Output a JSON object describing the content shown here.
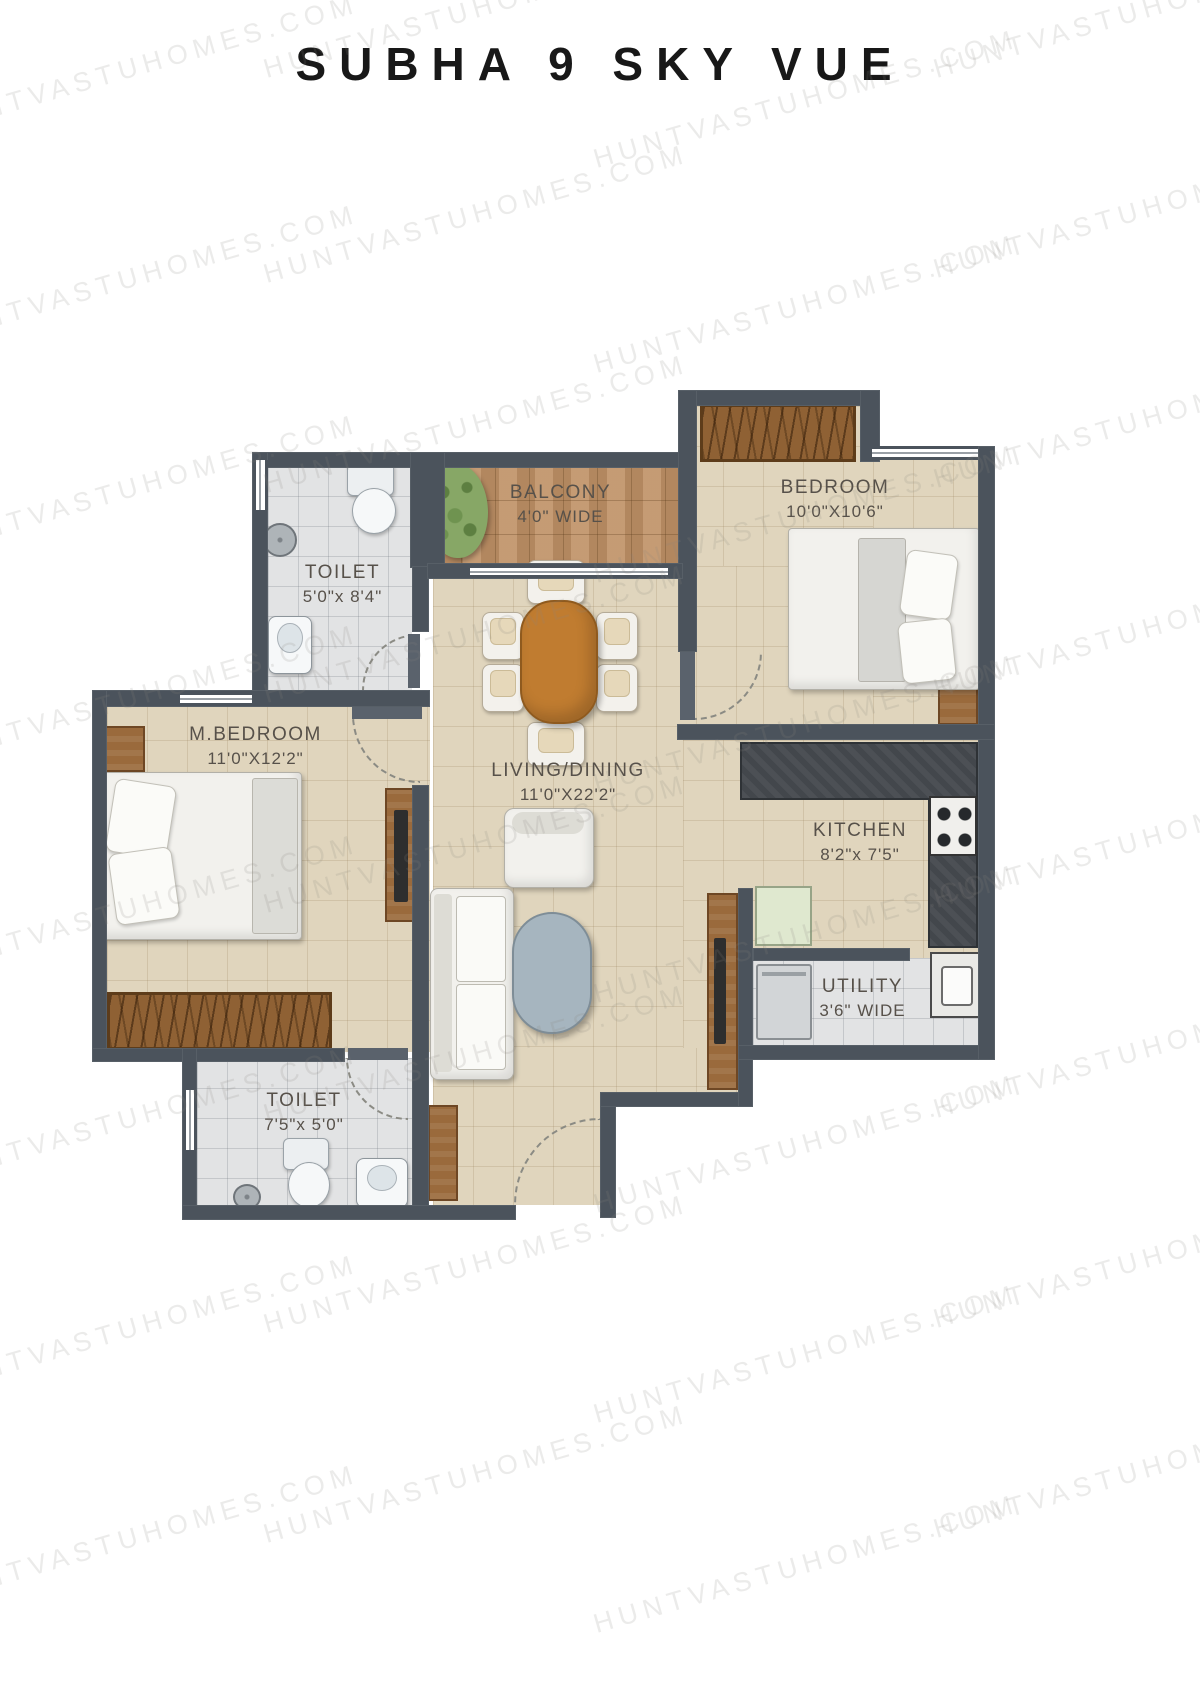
{
  "title": "SUBHA 9 SKY VUE",
  "watermark": "HUNTVASTUHOMES.COM",
  "rooms": {
    "toilet_top": {
      "name": "TOILET",
      "dims": "5'0\"x 8'4\""
    },
    "balcony": {
      "name": "BALCONY",
      "dims": "4'0\" WIDE"
    },
    "bedroom": {
      "name": "BEDROOM",
      "dims": "10'0\"X10'6\""
    },
    "master_bedroom": {
      "name": "M.BEDROOM",
      "dims": "11'0\"X12'2\""
    },
    "living_dining": {
      "name": "LIVING/DINING",
      "dims": "11'0\"X22'2\""
    },
    "kitchen": {
      "name": "KITCHEN",
      "dims": "8'2\"x 7'5\""
    },
    "utility": {
      "name": "UTILITY",
      "dims": "3'6\" WIDE"
    },
    "toilet_bottom": {
      "name": "TOILET",
      "dims": "7'5\"x 5'0\""
    }
  },
  "colors": {
    "wall": "#4b535c",
    "floor_beige": "#e0d5bd",
    "floor_tile_gray": "#e2e3e4",
    "balcony_tile": "#bd9168",
    "counter_dark": "#43474c",
    "wood": "#9a6a3c",
    "dining_table": "#c07c30",
    "coffee_table": "#a6b5bf",
    "plant_green": "#87a766",
    "label_text": "#57514a",
    "title_text": "#181818"
  }
}
